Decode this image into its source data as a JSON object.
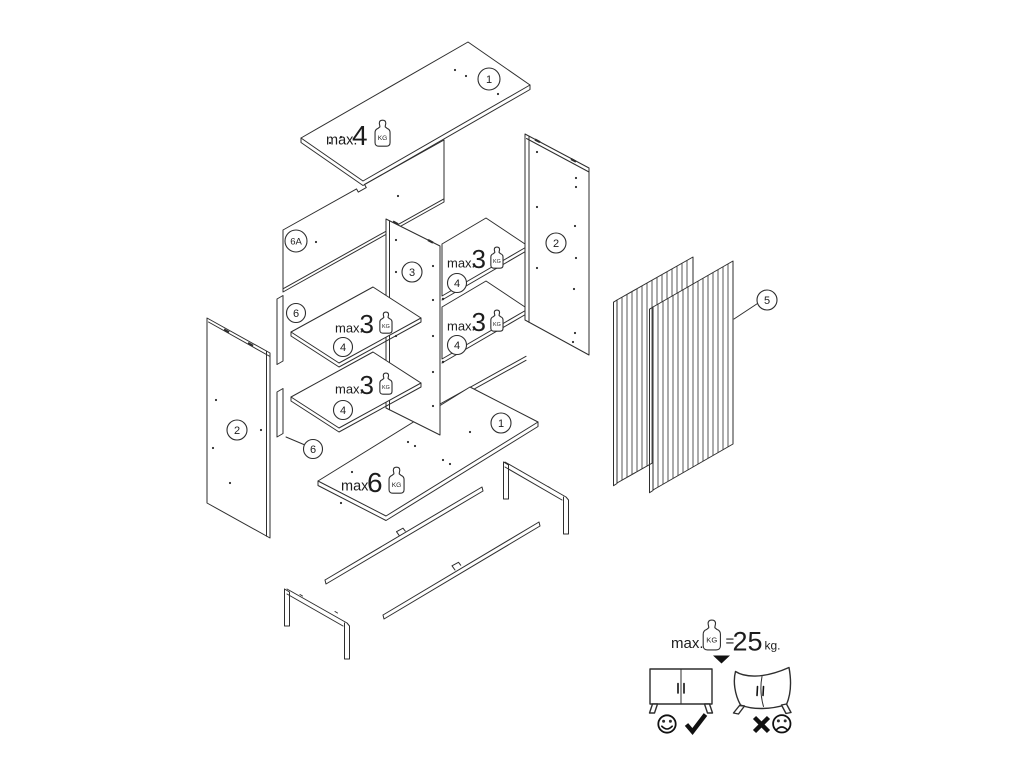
{
  "diagram": {
    "kind": "exploded furniture assembly instructions",
    "background": "#ffffff",
    "line_color": "#2e2e2e"
  },
  "callouts": [
    {
      "part": "top-panel",
      "label": "1"
    },
    {
      "part": "back-panel",
      "label": "6A"
    },
    {
      "part": "side-panel-right",
      "label": "2"
    },
    {
      "part": "center-divider",
      "label": "3"
    },
    {
      "part": "shelf-right-upper",
      "label": "4"
    },
    {
      "part": "back-rail-upper",
      "label": "6"
    },
    {
      "part": "shelf-left-upper",
      "label": "4"
    },
    {
      "part": "shelf-right-lower",
      "label": "4"
    },
    {
      "part": "shelf-left-lower",
      "label": "4"
    },
    {
      "part": "side-panel-left",
      "label": "2"
    },
    {
      "part": "back-rail-lower",
      "label": "6"
    },
    {
      "part": "bottom-panel",
      "label": "1"
    },
    {
      "part": "doors",
      "label": "5"
    }
  ],
  "weights": {
    "unit": "KG",
    "top_panel": {
      "prefix": "max.",
      "value": "4"
    },
    "shelf_left_upper": {
      "prefix": "max.",
      "value": "3"
    },
    "shelf_left_lower": {
      "prefix": "max.",
      "value": "3"
    },
    "shelf_right_upper": {
      "prefix": "max.",
      "value": "3"
    },
    "shelf_right_lower": {
      "prefix": "max.",
      "value": "3"
    },
    "bottom_panel": {
      "prefix": "max.",
      "value": "6"
    }
  },
  "legend": {
    "prefix": "max.",
    "icon_unit": "KG",
    "equals": "=",
    "max_total": "25",
    "unit": "kg."
  }
}
